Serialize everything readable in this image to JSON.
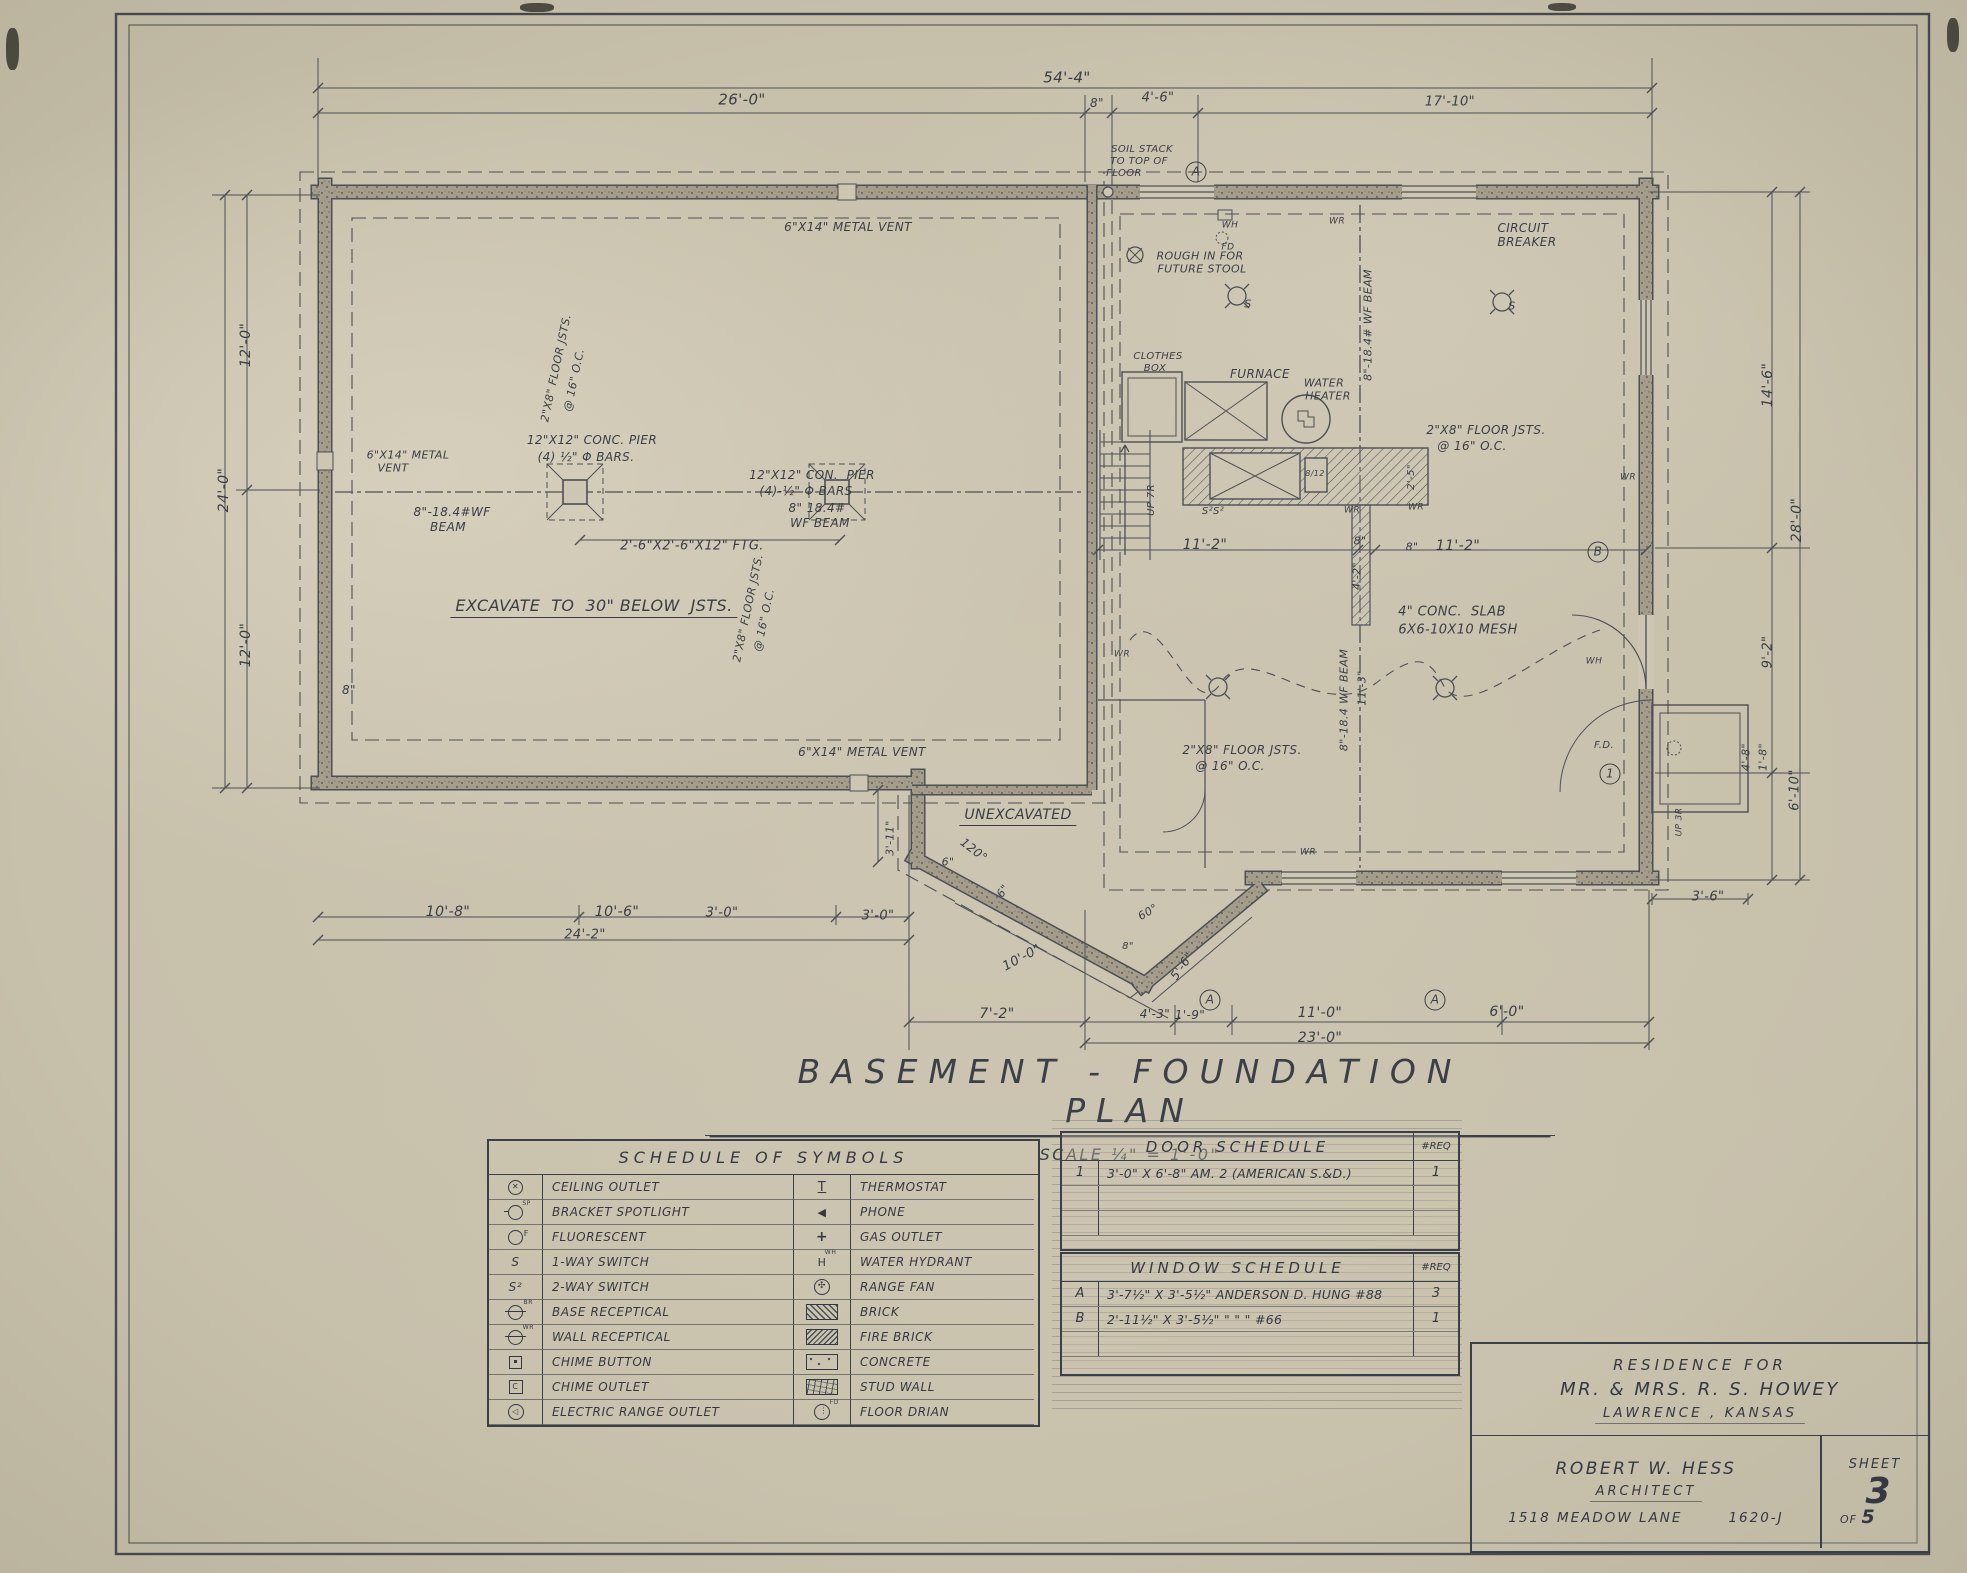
{
  "colors": {
    "paper": "#cbc4b0",
    "ink": "#3b3f47",
    "wall_fill": "#a39c8b",
    "hatch": "#4a4e57"
  },
  "title": {
    "text": "BASEMENT - FOUNDATION  PLAN",
    "scale": "SCALE   ¼\" = 1'-0\""
  },
  "title_block": {
    "line1": "RESIDENCE   FOR",
    "line2": "MR. & MRS.  R. S.  HOWEY",
    "line3": "LAWRENCE ,  KANSAS",
    "architect_name": "ROBERT W.  HESS",
    "architect_role": "ARCHITECT",
    "address": "1518  MEADOW  LANE",
    "job_number": "1620-J",
    "sheet_label": "SHEET",
    "sheet_number": "3",
    "of_label": "OF",
    "sheet_total": "5"
  },
  "symbol_schedule": {
    "title": "SCHEDULE  OF  SYMBOLS",
    "rows": [
      {
        "l_icon": "ceiling-outlet",
        "l_label": "CEILING OUTLET",
        "r_icon": "thermostat",
        "r_label": "THERMOSTAT"
      },
      {
        "l_icon": "bracket-spotlight",
        "l_label": "BRACKET SPOTLIGHT",
        "r_icon": "phone",
        "r_label": "PHONE"
      },
      {
        "l_icon": "fluorescent",
        "l_label": "FLUORESCENT",
        "r_icon": "gas-outlet",
        "r_label": "GAS OUTLET"
      },
      {
        "l_icon": "one-way-switch",
        "l_label": "1-WAY SWITCH",
        "r_icon": "water-hydrant",
        "r_label": "WATER  HYDRANT"
      },
      {
        "l_icon": "two-way-switch",
        "l_label": "2-WAY SWITCH",
        "r_icon": "range-fan",
        "r_label": "RANGE FAN"
      },
      {
        "l_icon": "base-receptacle",
        "l_label": "BASE RECEPTICAL",
        "r_icon": "brick",
        "r_label": "BRICK"
      },
      {
        "l_icon": "wall-receptacle",
        "l_label": "WALL  RECEPTICAL",
        "r_icon": "fire-brick",
        "r_label": "FIRE BRICK"
      },
      {
        "l_icon": "chime-button",
        "l_label": "CHIME  BUTTON",
        "r_icon": "concrete",
        "r_label": "CONCRETE"
      },
      {
        "l_icon": "chime-outlet",
        "l_label": "CHIME  OUTLET",
        "r_icon": "stud-wall",
        "r_label": "STUD WALL"
      },
      {
        "l_icon": "electric-range-outlet",
        "l_label": "ELECTRIC RANGE OUTLET",
        "r_icon": "floor-drain",
        "r_label": "FLOOR  DRIAN"
      }
    ]
  },
  "door_schedule": {
    "title": "DOOR    SCHEDULE",
    "req_header": "#REQ",
    "rows": [
      {
        "mark": "1",
        "desc": "3'-0\" X 6'-8\"  AM. 2  (AMERICAN S.&D.)",
        "req": "1"
      }
    ]
  },
  "window_schedule": {
    "title": "WINDOW   SCHEDULE",
    "req_header": "#REQ",
    "rows": [
      {
        "mark": "A",
        "desc": "3'-7½\" X 3'-5½\" ANDERSON D. HUNG #88",
        "req": "3"
      },
      {
        "mark": "B",
        "desc": "2'-11½\" X 3'-5½\"    \"      \"      \"   #66",
        "req": "1"
      }
    ]
  },
  "plan": {
    "labels": [
      {
        "t": "54'-4\"",
        "x": 1067,
        "y": 78,
        "s": 15
      },
      {
        "t": "26'-0\"",
        "x": 742,
        "y": 100,
        "s": 15
      },
      {
        "t": "8\"",
        "x": 1097,
        "y": 103,
        "s": 12
      },
      {
        "t": "4'-6\"",
        "x": 1158,
        "y": 98,
        "s": 13
      },
      {
        "t": "17'-10\"",
        "x": 1450,
        "y": 102,
        "s": 13
      },
      {
        "t": "SOIL STACK",
        "x": 1142,
        "y": 150,
        "s": 10
      },
      {
        "t": "TO TOP OF",
        "x": 1139,
        "y": 162,
        "s": 10
      },
      {
        "t": "FLOOR",
        "x": 1124,
        "y": 174,
        "s": 10
      },
      {
        "t": "A",
        "x": 1196,
        "y": 172,
        "circle": true
      },
      {
        "t": "12'-0\"",
        "x": 246,
        "y": 345,
        "s": 14,
        "r": -90
      },
      {
        "t": "24'-0\"",
        "x": 224,
        "y": 490,
        "s": 14,
        "r": -90
      },
      {
        "t": "12'-0\"",
        "x": 246,
        "y": 645,
        "s": 14,
        "r": -90
      },
      {
        "t": "8\"",
        "x": 349,
        "y": 690,
        "s": 12
      },
      {
        "t": "14'-6\"",
        "x": 1768,
        "y": 385,
        "s": 14,
        "r": -90
      },
      {
        "t": "28'-0\"",
        "x": 1797,
        "y": 520,
        "s": 14,
        "r": -90
      },
      {
        "t": "9'-2\"",
        "x": 1768,
        "y": 652,
        "s": 13,
        "r": -90
      },
      {
        "t": "4'-8\"",
        "x": 1746,
        "y": 757,
        "s": 11,
        "r": -90
      },
      {
        "t": "1'-8\"",
        "x": 1763,
        "y": 757,
        "s": 11,
        "r": -90
      },
      {
        "t": "6'-10\"",
        "x": 1795,
        "y": 790,
        "s": 13,
        "r": -90
      },
      {
        "t": "3'-6\"",
        "x": 1708,
        "y": 897,
        "s": 13
      },
      {
        "t": "6\"X14\" METAL VENT",
        "x": 848,
        "y": 227,
        "s": 12
      },
      {
        "t": "WH",
        "x": 1230,
        "y": 226,
        "s": 9
      },
      {
        "t": "FD",
        "x": 1228,
        "y": 248,
        "s": 9
      },
      {
        "t": "ROUGH IN FOR",
        "x": 1200,
        "y": 256,
        "s": 11
      },
      {
        "t": "FUTURE STOOL",
        "x": 1202,
        "y": 269,
        "s": 11
      },
      {
        "t": "WR",
        "x": 1337,
        "y": 222,
        "s": 9
      },
      {
        "t": "CIRCUIT",
        "x": 1523,
        "y": 228,
        "s": 12
      },
      {
        "t": "BREAKER",
        "x": 1527,
        "y": 242,
        "s": 12
      },
      {
        "t": "S",
        "x": 1248,
        "y": 304,
        "s": 11
      },
      {
        "t": "S",
        "x": 1512,
        "y": 306,
        "s": 11
      },
      {
        "t": "CLOTHES",
        "x": 1158,
        "y": 357,
        "s": 10
      },
      {
        "t": "BOX",
        "x": 1155,
        "y": 369,
        "s": 10
      },
      {
        "t": "FURNACE",
        "x": 1260,
        "y": 374,
        "s": 12
      },
      {
        "t": "WATER",
        "x": 1324,
        "y": 383,
        "s": 11
      },
      {
        "t": "HEATER",
        "x": 1328,
        "y": 396,
        "s": 11
      },
      {
        "t": "8\"-18.4# WF BEAM",
        "x": 1368,
        "y": 325,
        "s": 11,
        "r": -90
      },
      {
        "t": "2\"X8\" FLOOR JSTS.",
        "x": 1486,
        "y": 430,
        "s": 12
      },
      {
        "t": "@ 16\" O.C.",
        "x": 1472,
        "y": 446,
        "s": 12
      },
      {
        "t": "2\"X8\" FLOOR JSTS.",
        "x": 556,
        "y": 368,
        "s": 11,
        "r": -78
      },
      {
        "t": "@ 16\" O.C.",
        "x": 574,
        "y": 380,
        "s": 11,
        "r": -78
      },
      {
        "t": "12\"X12\" CONC. PIER",
        "x": 592,
        "y": 440,
        "s": 12
      },
      {
        "t": "(4) ½\" Φ BARS.",
        "x": 586,
        "y": 457,
        "s": 12
      },
      {
        "t": "12\"X12\" CON.  PIER",
        "x": 812,
        "y": 475,
        "s": 12
      },
      {
        "t": "(4)-½\" Φ BARS",
        "x": 806,
        "y": 491,
        "s": 12
      },
      {
        "t": "8\"-18.4#WF",
        "x": 452,
        "y": 512,
        "s": 12
      },
      {
        "t": "BEAM",
        "x": 448,
        "y": 527,
        "s": 12
      },
      {
        "t": "8\" 18.4#",
        "x": 817,
        "y": 508,
        "s": 12
      },
      {
        "t": "WF BEAM",
        "x": 820,
        "y": 523,
        "s": 12
      },
      {
        "t": "2'-6\"X2'-6\"X12\" FTG.",
        "x": 692,
        "y": 546,
        "s": 13
      },
      {
        "t": "EXCAVATE  TO  30\" BELOW  JSTS.",
        "x": 594,
        "y": 608,
        "s": 16,
        "u": true
      },
      {
        "t": "6\"X14\" METAL",
        "x": 408,
        "y": 455,
        "s": 11
      },
      {
        "t": "VENT",
        "x": 393,
        "y": 468,
        "s": 11
      },
      {
        "t": "2\"X8\" FLOOR JSTS.",
        "x": 748,
        "y": 608,
        "s": 11,
        "r": -78
      },
      {
        "t": "@ 16\" O.C.",
        "x": 764,
        "y": 620,
        "s": 11,
        "r": -78
      },
      {
        "t": "UP 7R",
        "x": 1152,
        "y": 500,
        "s": 10,
        "r": -90
      },
      {
        "t": "S²S²",
        "x": 1213,
        "y": 512,
        "s": 10
      },
      {
        "t": "WR",
        "x": 1352,
        "y": 511,
        "s": 9
      },
      {
        "t": "WR",
        "x": 1416,
        "y": 508,
        "s": 9
      },
      {
        "t": "2'-5\"",
        "x": 1412,
        "y": 477,
        "s": 10,
        "r": -90
      },
      {
        "t": "8\"",
        "x": 1412,
        "y": 547,
        "s": 11
      },
      {
        "t": "8/12",
        "x": 1315,
        "y": 474,
        "s": 8
      },
      {
        "t": "11'-2\"",
        "x": 1205,
        "y": 545,
        "s": 14
      },
      {
        "t": "8\"",
        "x": 1360,
        "y": 541,
        "s": 11
      },
      {
        "t": "11'-2\"",
        "x": 1458,
        "y": 546,
        "s": 14
      },
      {
        "t": "B",
        "x": 1598,
        "y": 552,
        "circle": true
      },
      {
        "t": "4'-2\"",
        "x": 1357,
        "y": 576,
        "s": 11,
        "r": -90
      },
      {
        "t": "4\" CONC.  SLAB",
        "x": 1452,
        "y": 612,
        "s": 13
      },
      {
        "t": "6X6-10X10 MESH",
        "x": 1458,
        "y": 630,
        "s": 13
      },
      {
        "t": "WR",
        "x": 1122,
        "y": 655,
        "s": 9
      },
      {
        "t": "WR",
        "x": 1628,
        "y": 478,
        "s": 9
      },
      {
        "t": "11'-3\"",
        "x": 1362,
        "y": 688,
        "s": 11,
        "r": -90
      },
      {
        "t": "8\"-18.4 WF BEAM",
        "x": 1344,
        "y": 700,
        "s": 11,
        "r": -90
      },
      {
        "t": "2\"X8\" FLOOR JSTS.",
        "x": 1242,
        "y": 750,
        "s": 12
      },
      {
        "t": "@ 16\" O.C.",
        "x": 1230,
        "y": 766,
        "s": 12
      },
      {
        "t": "WH",
        "x": 1594,
        "y": 662,
        "s": 9
      },
      {
        "t": "WR",
        "x": 1308,
        "y": 853,
        "s": 9
      },
      {
        "t": "UNEXCAVATED",
        "x": 1018,
        "y": 817,
        "s": 14,
        "u": true
      },
      {
        "t": "3'-11\"",
        "x": 890,
        "y": 838,
        "s": 11,
        "r": -90
      },
      {
        "t": "120°",
        "x": 974,
        "y": 850,
        "s": 12,
        "r": 38
      },
      {
        "t": "6\"",
        "x": 948,
        "y": 862,
        "s": 11
      },
      {
        "t": "6\"",
        "x": 1003,
        "y": 891,
        "s": 11,
        "r": -55
      },
      {
        "t": "3'-0\"",
        "x": 878,
        "y": 916,
        "s": 13
      },
      {
        "t": "10'-0\"",
        "x": 1022,
        "y": 958,
        "s": 13,
        "r": -28
      },
      {
        "t": "60°",
        "x": 1148,
        "y": 912,
        "s": 11,
        "r": -30
      },
      {
        "t": "8\"",
        "x": 1128,
        "y": 947,
        "s": 10
      },
      {
        "t": "5'-6\"",
        "x": 1182,
        "y": 966,
        "s": 12,
        "r": -55
      },
      {
        "t": "6\"X14\" METAL VENT",
        "x": 862,
        "y": 752,
        "s": 12
      },
      {
        "t": "10'-8\"",
        "x": 448,
        "y": 912,
        "s": 14
      },
      {
        "t": "10'-6\"",
        "x": 617,
        "y": 912,
        "s": 14
      },
      {
        "t": "3'-0\"",
        "x": 722,
        "y": 913,
        "s": 13
      },
      {
        "t": "24'-2\"",
        "x": 585,
        "y": 935,
        "s": 13
      },
      {
        "t": "7'-2\"",
        "x": 997,
        "y": 1014,
        "s": 14
      },
      {
        "t": "4'-3\"",
        "x": 1155,
        "y": 1014,
        "s": 12
      },
      {
        "t": "1'-9\"",
        "x": 1190,
        "y": 1015,
        "s": 12
      },
      {
        "t": "11'-0\"",
        "x": 1320,
        "y": 1013,
        "s": 14
      },
      {
        "t": "6'-0\"",
        "x": 1507,
        "y": 1012,
        "s": 14
      },
      {
        "t": "23'-0\"",
        "x": 1320,
        "y": 1038,
        "s": 14
      },
      {
        "t": "A",
        "x": 1210,
        "y": 1000,
        "circle": true
      },
      {
        "t": "A",
        "x": 1435,
        "y": 1000,
        "circle": true
      },
      {
        "t": "F.D.",
        "x": 1604,
        "y": 746,
        "s": 10
      },
      {
        "t": "1",
        "x": 1610,
        "y": 774,
        "circle": true
      },
      {
        "t": "UP 3R",
        "x": 1680,
        "y": 822,
        "s": 9,
        "r": -90
      }
    ]
  }
}
